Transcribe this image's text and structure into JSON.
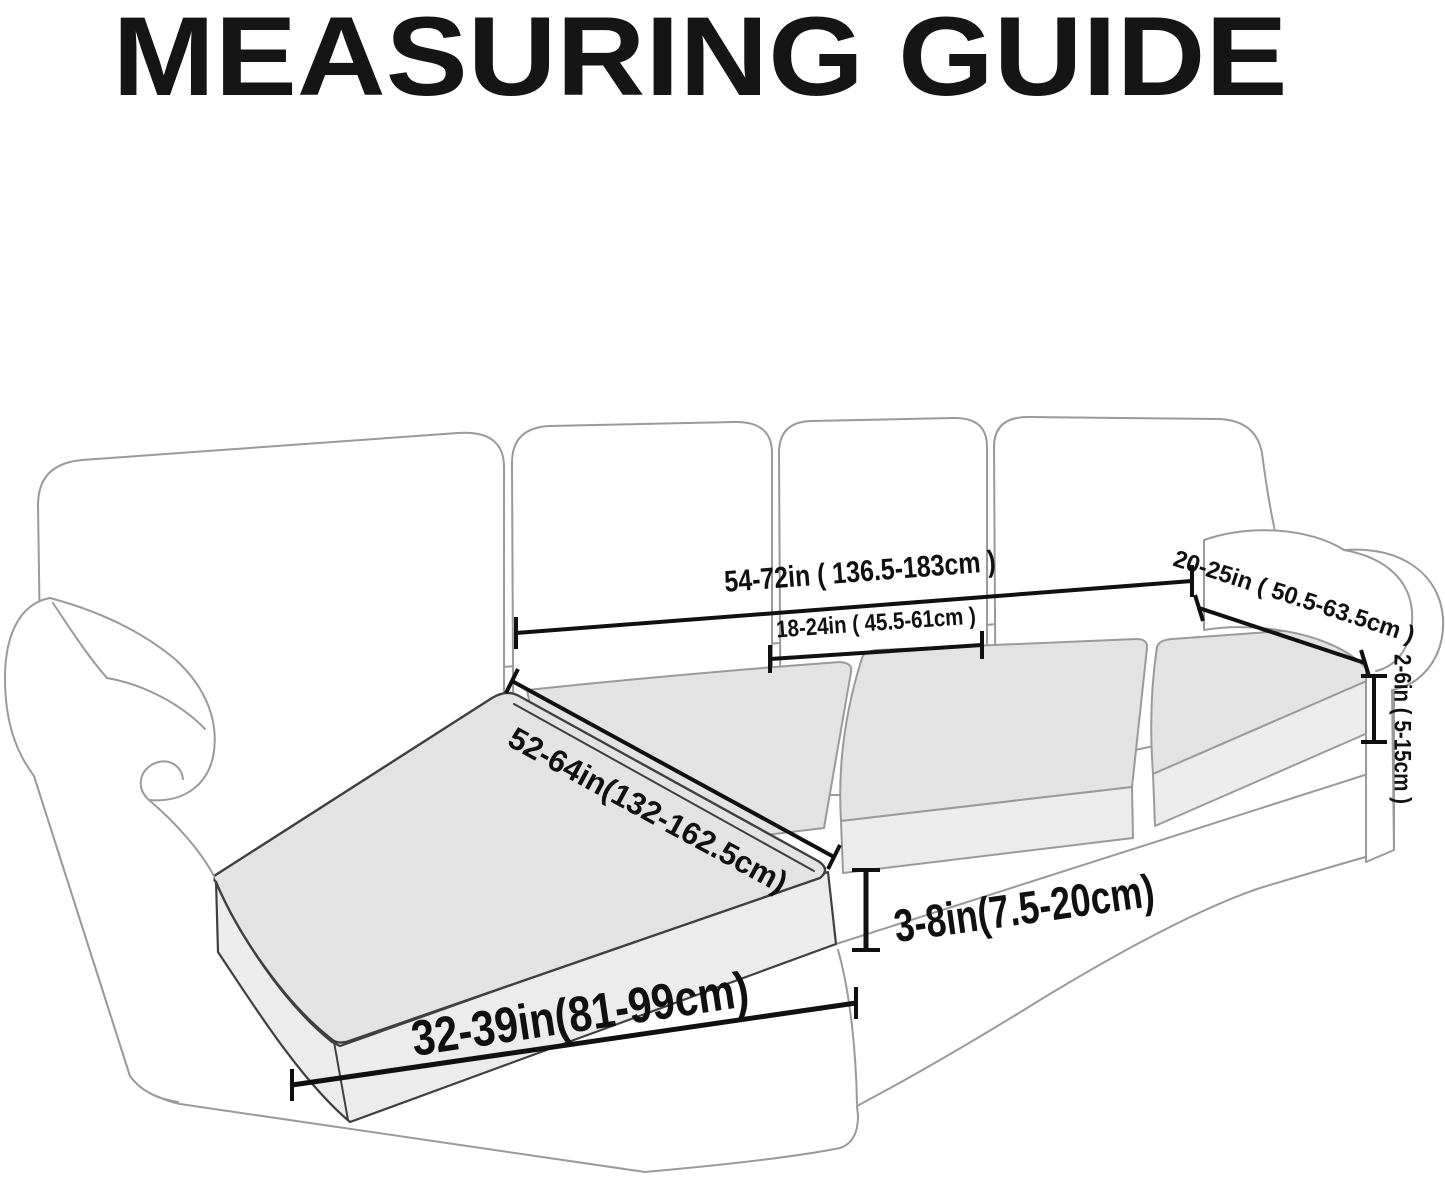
{
  "title": "MEASURING GUIDE",
  "measurements": {
    "back_width": "54-72in ( 136.5-183cm )",
    "seat_cushion_width": "18-24in ( 45.5-61cm )",
    "armrest_length": "20-25in ( 50.5-63.5cm )",
    "seat_to_armrest_height": "2-6in ( 5-15cm )",
    "chaise_length": "52-64in(132-162.5cm)",
    "cushion_thickness": "3-8in(7.5-20cm)",
    "chaise_width": "32-39in(81-99cm)"
  },
  "colors": {
    "background": "#ffffff",
    "title_text": "#151515",
    "annotation": "#101010",
    "sofa_outline_light": "#9a9a9a",
    "sofa_outline_dark": "#3f3f3f",
    "cushion_top_fill": "#e3e3e4",
    "cushion_side_fill": "#ececed",
    "sofa_fill": "#ffffff"
  }
}
